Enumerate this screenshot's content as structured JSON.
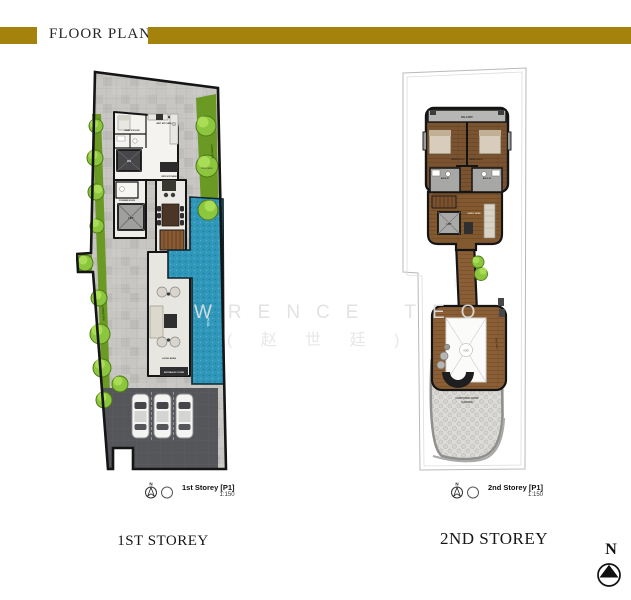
{
  "header": {
    "title": "FLOOR PLANS"
  },
  "watermark": {
    "line1": "WRENCE TEO",
    "line2": "( 赵 世 廷 )"
  },
  "compass": {
    "label": "N"
  },
  "colors": {
    "accent_gold": "#A5820B",
    "pool_blue": "#2E97BA",
    "landscape_green": "#8CC63E",
    "wood_brown": "#7F5733",
    "paving_gray": "#C7C6C2",
    "carporch_gray": "#55565A"
  },
  "plan1": {
    "caption": "1ST STOREY",
    "storey_label": "1st Storey [P1]",
    "scale": "1:150",
    "labels": {
      "maids_room": "MAID'S ROOM",
      "wet_kitchen": "WET KITCHEN",
      "dry_kitchen": "DRY KITCHEN",
      "powder_room": "POWDER ROOM",
      "household_shelter": "HS",
      "lift": "LIFT",
      "landscape_left": "LANDSCAPE",
      "landscape_right": "LANDSCAPE",
      "pool_deck": "POOL DECK",
      "pool": "POOL",
      "living_area": "LIVING AREA",
      "entrance_foyer": "ENTRANCE FOYER"
    }
  },
  "plan2": {
    "caption": "2ND STOREY",
    "storey_label": "2nd Storey [P1]",
    "scale": "1:150",
    "labels": {
      "balcony": "BALCONY",
      "bedroom_01": "BEDROOM 01",
      "bedroom_02": "BEDROOM 02",
      "bath_01": "BATH 01",
      "bath_02": "BATH 02",
      "family_area": "FAMILY AREA",
      "lift": "LIFT",
      "gallery": "GALLERY",
      "void": "VOID",
      "balcony_side": "BALCONY",
      "roof_garden_line1": "CARPORCH ROOF",
      "roof_garden_line2": "GARDEN"
    }
  }
}
